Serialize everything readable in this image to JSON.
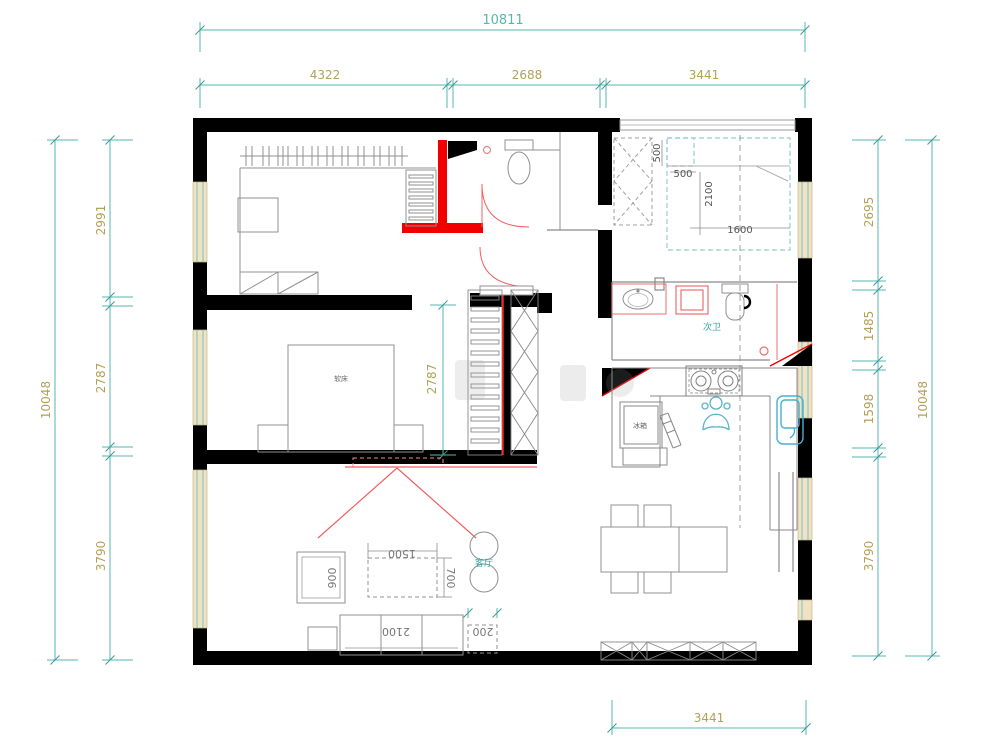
{
  "plan": {
    "dims": {
      "top_total": "10811",
      "top_seg1": "4322",
      "top_seg2": "2688",
      "top_seg3": "3441",
      "left_total": "10048",
      "left_seg1": "2991",
      "left_seg2": "2787",
      "left_seg3": "3790",
      "right_total": "10048",
      "right_seg1": "2695",
      "right_seg2": "1485",
      "right_seg3": "1598",
      "right_seg4": "3790",
      "bottom_seg": "3441",
      "master_interior": "2787"
    },
    "bed2": {
      "side_v": "500",
      "side_h": "500",
      "length": "2100",
      "width": "1600"
    },
    "living": {
      "armchair": "900",
      "table_w": "1500",
      "table_d": "700",
      "sofa": "2100",
      "side_table": "200"
    },
    "labels": {
      "bath2": "次卫",
      "living": "客厅",
      "bed": "软床",
      "fridge": "冰箱"
    },
    "colors": {
      "dim_line": "#56b7b1",
      "dim_text_olive": "#b3a156",
      "wall": "#000000",
      "new_wall": "#f20000",
      "furniture_line": "#909090",
      "fixture_blue": "#45b0d0",
      "bed_outline": "#a8d4da",
      "window_fill": "#f0e2c4"
    }
  }
}
